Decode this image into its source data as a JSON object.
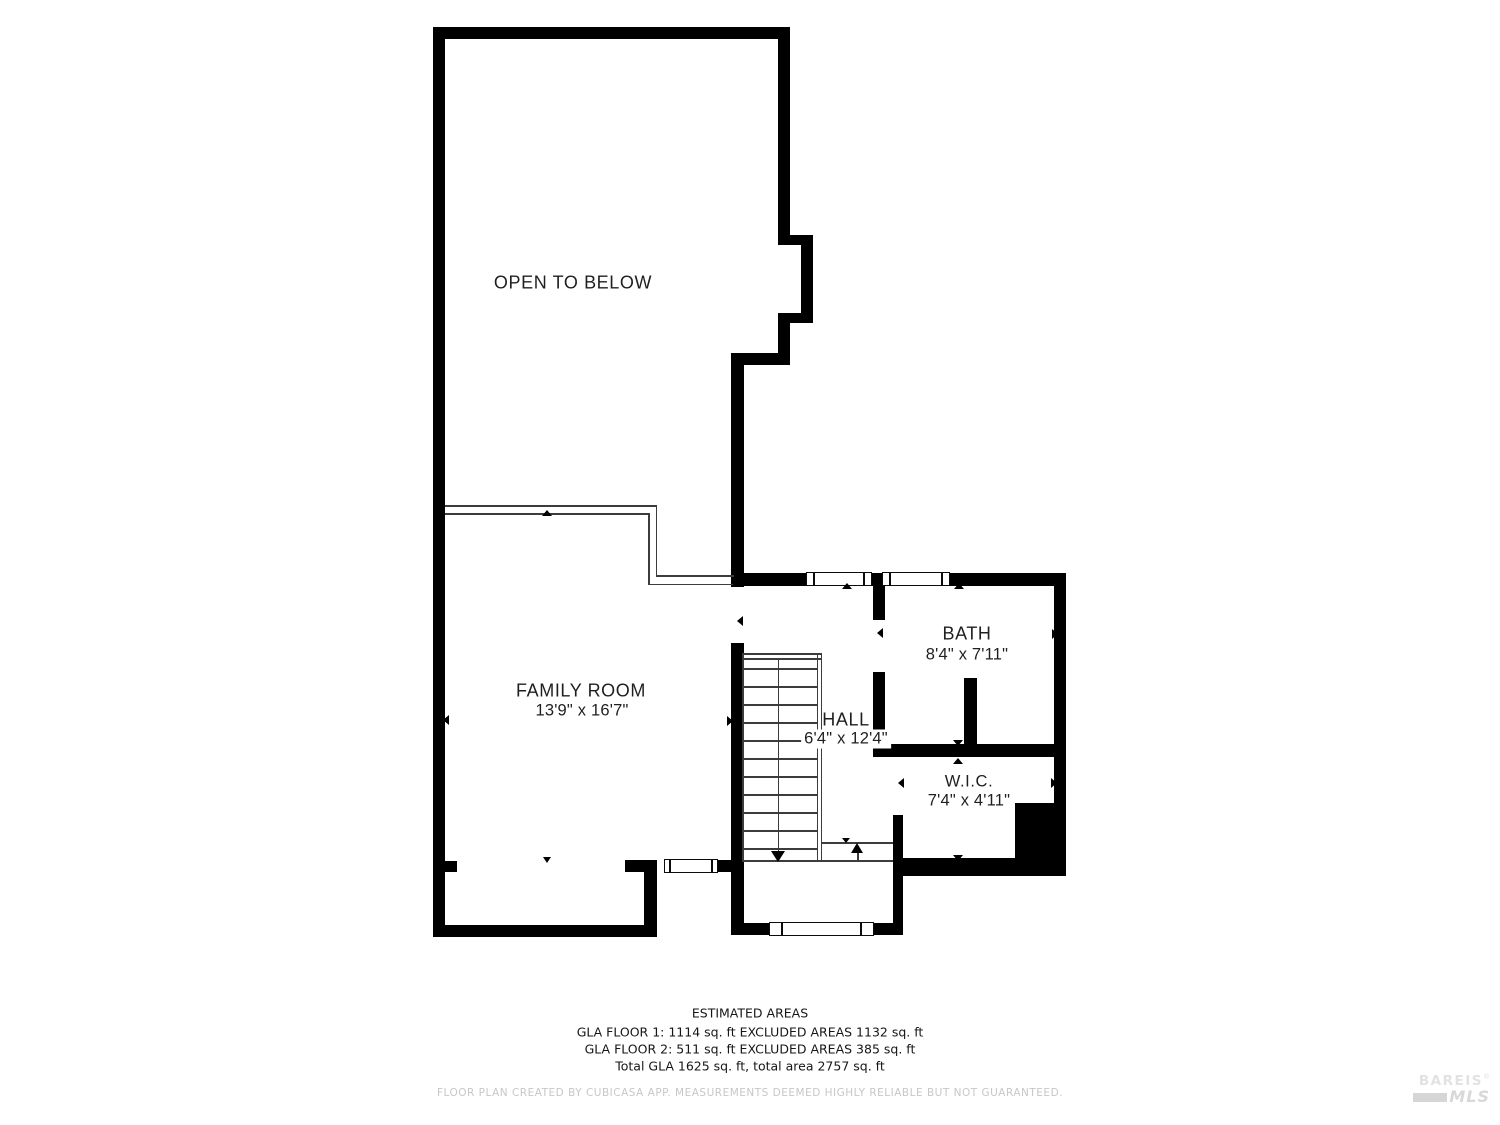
{
  "plan": {
    "rooms": {
      "open_to_below": {
        "label": "OPEN TO BELOW"
      },
      "family_room": {
        "label": "FAMILY ROOM",
        "dims": "13'9\" x 16'7\""
      },
      "hall": {
        "label": "HALL",
        "dims": "6'4\" x 12'4\""
      },
      "bath": {
        "label": "BATH",
        "dims": "8'4\" x 7'11\""
      },
      "wic": {
        "label": "W.I.C.",
        "dims": "7'4\" x 4'11\""
      }
    }
  },
  "footer": {
    "title": "ESTIMATED AREAS",
    "line1": "GLA FLOOR 1: 1114 sq. ft EXCLUDED AREAS 1132 sq. ft",
    "line2": "GLA FLOOR 2: 511 sq. ft EXCLUDED AREAS 385 sq. ft",
    "line3": "Total GLA 1625 sq. ft, total area 2757 sq. ft",
    "disclaimer": "FLOOR PLAN CREATED BY CUBICASA APP. MEASUREMENTS DEEMED HIGHLY RELIABLE BUT NOT GUARANTEED."
  },
  "watermark": {
    "brand": "BAREIS",
    "registered": "®",
    "sub": "MLS"
  },
  "colors": {
    "wall": "#000000",
    "thin_line": "#3c3c3c",
    "disclaimer_text": "#c7c7c7",
    "watermark_text": "#e0e0e0"
  }
}
